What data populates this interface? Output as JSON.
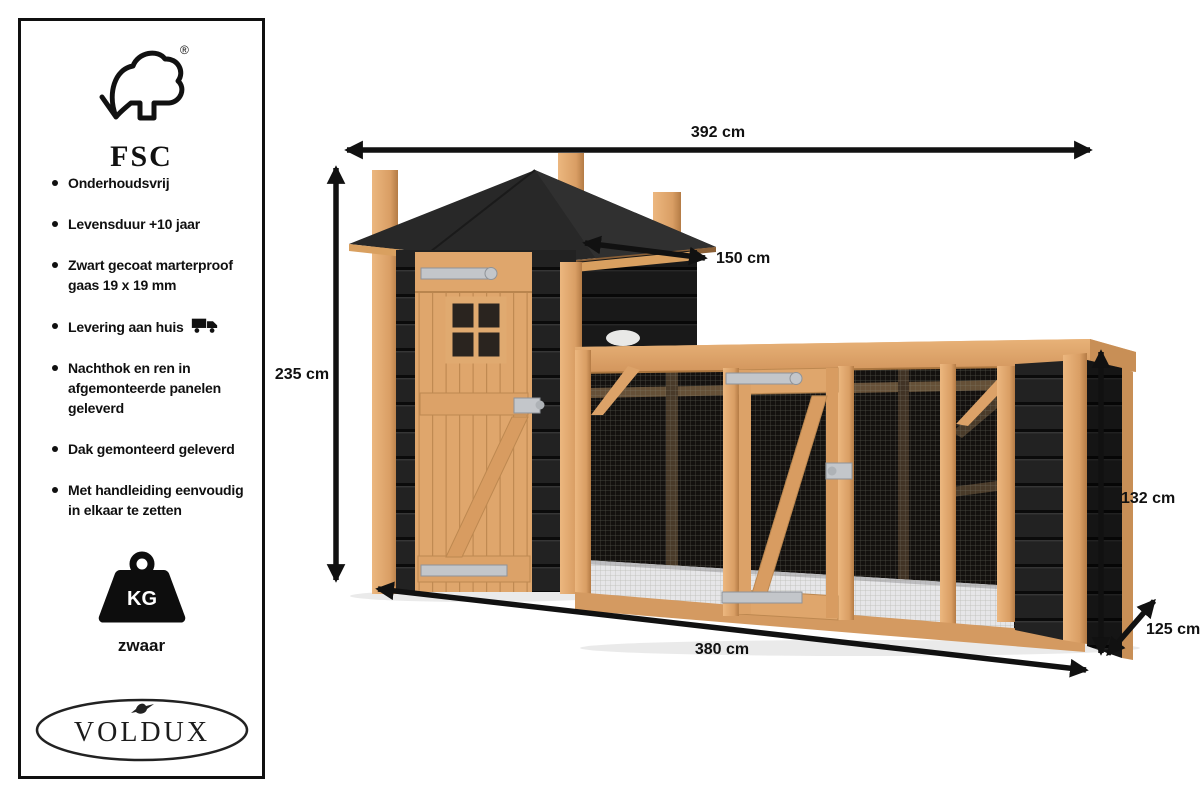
{
  "sidebar": {
    "fsc": {
      "label": "FSC",
      "registered_mark": "®",
      "icon": "fsc-tree-check-icon"
    },
    "features": [
      {
        "text": "Onderhoudsvrij"
      },
      {
        "text": "Levensduur +10 jaar"
      },
      {
        "text": "Zwart gecoat marterproof gaas 19 x 19 mm"
      },
      {
        "text": "Levering aan huis",
        "icon": "truck-icon"
      },
      {
        "text": "Nachthok en ren in afgemonteerde panelen geleverd"
      },
      {
        "text": "Dak gemonteerd geleverd"
      },
      {
        "text": "Met handleiding eenvoudig in elkaar te zetten"
      }
    ],
    "weight": {
      "unit_label": "KG",
      "label": "zwaar",
      "icon": "weight-icon"
    },
    "brand": {
      "name": "VOLDUX",
      "icon": "bird-icon"
    }
  },
  "diagram": {
    "subject": "chicken coop with night house tower and mesh run",
    "dimensions": {
      "total_width": "392 cm",
      "roof_depth": "150 cm",
      "total_height": "235 cm",
      "run_height": "132 cm",
      "run_depth": "125 cm",
      "run_width": "380 cm"
    },
    "colors": {
      "wood": "#dfa66c",
      "wood_dark": "#c08a52",
      "black_wood": "#1f1f1f",
      "roof": "#262626",
      "mesh_interior": "#14110f",
      "floor": "#e6e6e8",
      "metal": "#c3c6ca",
      "arrow": "#111111",
      "background": "#ffffff"
    }
  }
}
